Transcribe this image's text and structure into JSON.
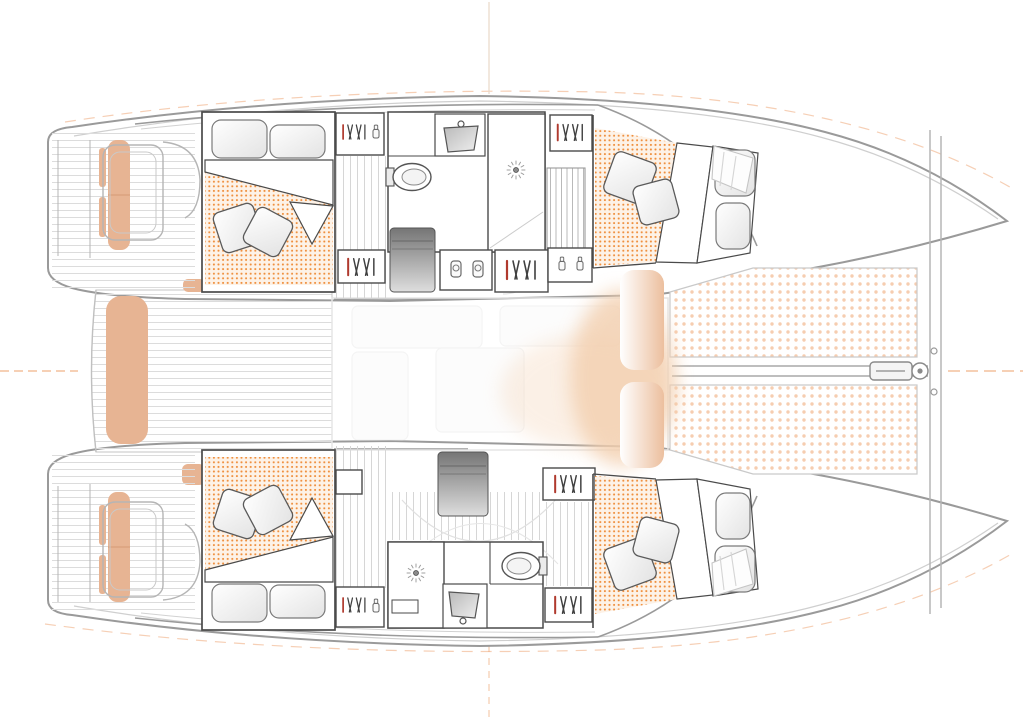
{
  "diagram": {
    "subject": "catamaran-interior-floor-plan",
    "view": "top-down-deck-plan",
    "layout_version": "4-cabin-2-head",
    "orientation": {
      "bow": "right",
      "stern": "left"
    },
    "zones": [
      {
        "id": "cockpit",
        "name": "aft cockpit with bench seats and twin helm stations"
      },
      {
        "id": "salon",
        "name": "bridgedeck salon (washed-out line work)"
      },
      {
        "id": "cabin-port-aft",
        "name": "port aft double cabin"
      },
      {
        "id": "cabin-port-forward",
        "name": "port forward double cabin"
      },
      {
        "id": "cabin-starboard-aft",
        "name": "starboard aft double cabin"
      },
      {
        "id": "cabin-starboard-forward",
        "name": "starboard forward double cabin"
      },
      {
        "id": "head-port",
        "name": "port head with shower, sink, toilet"
      },
      {
        "id": "head-starboard",
        "name": "starboard head with shower, sink, toilet"
      },
      {
        "id": "trampoline",
        "name": "bow trampolines with bowsprit"
      }
    ],
    "symbols_legend": [
      {
        "icon": "hangers-icon",
        "meaning": "wardrobe / hanging locker"
      },
      {
        "icon": "sun-drain-icon",
        "meaning": "shower drain"
      },
      {
        "icon": "glass-icon",
        "meaning": "stowage / glassware locker"
      },
      {
        "icon": "dot-grid",
        "meaning": "upholstered mattress / trampoline netting"
      }
    ]
  },
  "colors": {
    "background": "#ffffff",
    "hull_line": "#9a9a9a",
    "inner_line": "#cfcfcf",
    "wall_line": "#4a4a4a",
    "cushion_tan": "#e7b493",
    "bedspread_dot": "#ef8f3d",
    "bedspread_base": "#fdf2e7",
    "trampoline_dot": "#f6cdb0",
    "plank_line": "#d9d9d9",
    "module_dark": "#757575",
    "module_light": "#dedede",
    "registration_orange": "#eda06b",
    "centerline_beige": "#ead9c8",
    "glow_peach": "#f3cfae",
    "hanger_red": "#b03a2e",
    "hanger_dark": "#3f3f3f",
    "fixture_line": "#555555"
  },
  "counts": {
    "double_beds": 4,
    "toilets": 2,
    "showers": 2,
    "sinks": 2,
    "trampolines": 2
  }
}
